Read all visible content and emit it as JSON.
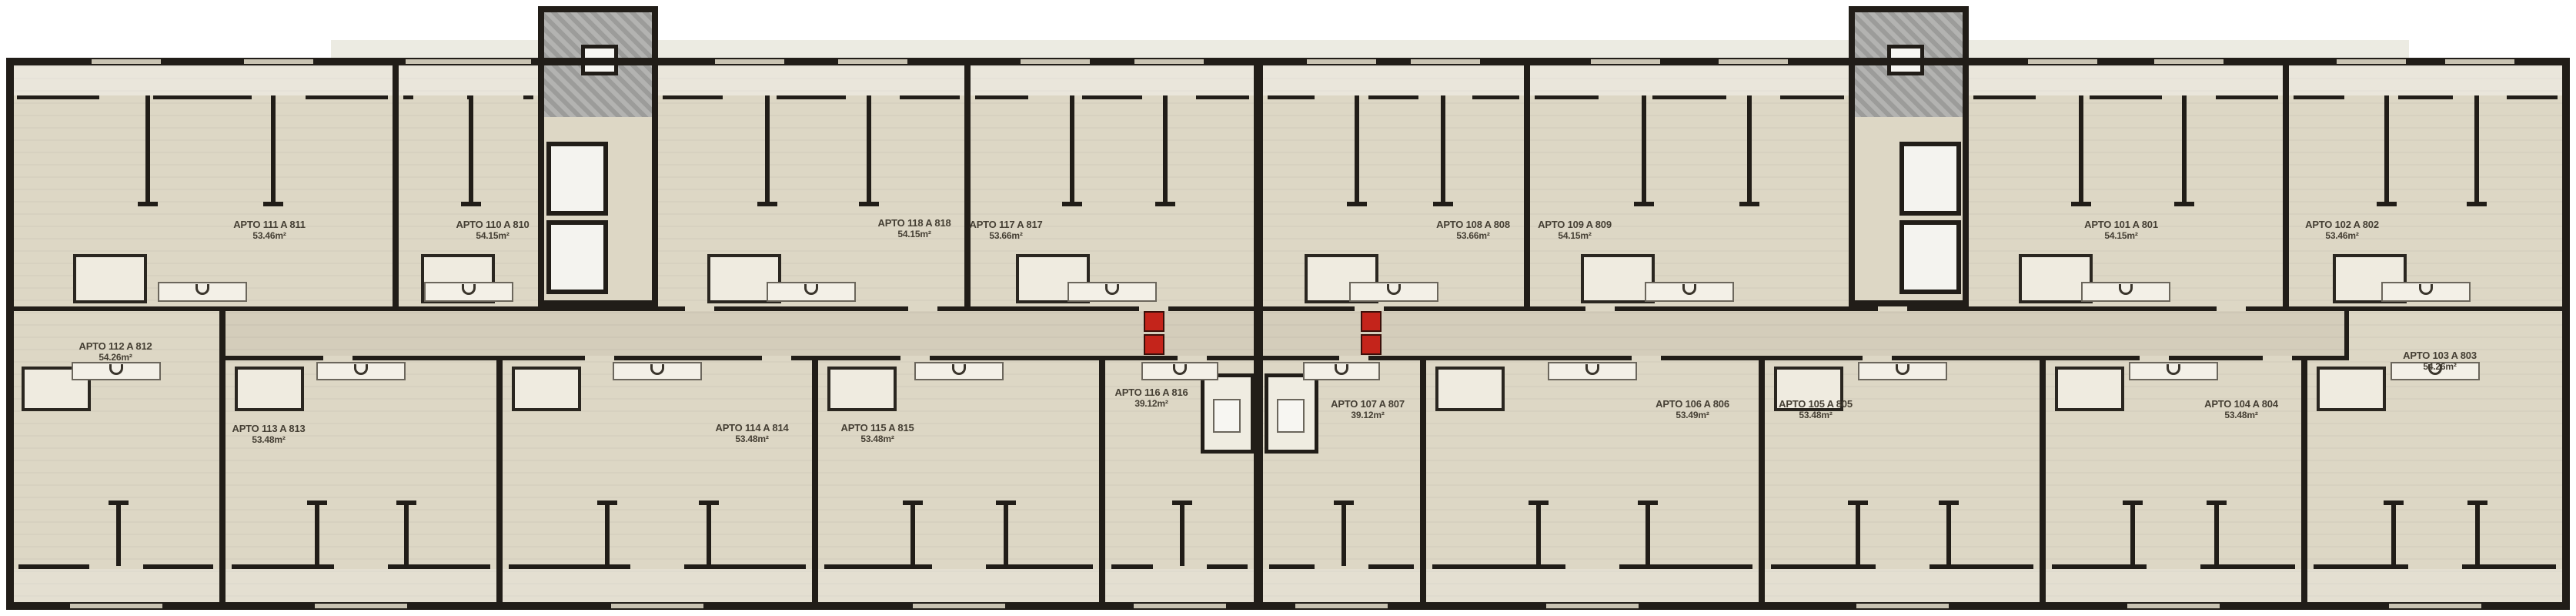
{
  "plan": {
    "apartments": [
      {
        "id": "111",
        "label": "APTO 111 A 811",
        "area": "53.46m²"
      },
      {
        "id": "110",
        "label": "APTO 110 A 810",
        "area": "54.15m²"
      },
      {
        "id": "118",
        "label": "APTO 118 A 818",
        "area": "54.15m²"
      },
      {
        "id": "117",
        "label": "APTO 117 A 817",
        "area": "53.66m²"
      },
      {
        "id": "108",
        "label": "APTO 108 A 808",
        "area": "53.66m²"
      },
      {
        "id": "109",
        "label": "APTO 109 A 809",
        "area": "54.15m²"
      },
      {
        "id": "101",
        "label": "APTO 101 A 801",
        "area": "54.15m²"
      },
      {
        "id": "102",
        "label": "APTO 102 A 802",
        "area": "53.46m²"
      },
      {
        "id": "112",
        "label": "APTO 112 A 812",
        "area": "54.26m²"
      },
      {
        "id": "113",
        "label": "APTO 113 A 813",
        "area": "53.48m²"
      },
      {
        "id": "114",
        "label": "APTO 114 A 814",
        "area": "53.48m²"
      },
      {
        "id": "115",
        "label": "APTO 115 A 815",
        "area": "53.48m²"
      },
      {
        "id": "116",
        "label": "APTO 116 A 816",
        "area": "39.12m²"
      },
      {
        "id": "107",
        "label": "APTO 107 A 807",
        "area": "39.12m²"
      },
      {
        "id": "106",
        "label": "APTO 106 A 806",
        "area": "53.49m²"
      },
      {
        "id": "105",
        "label": "APTO 105 A 805",
        "area": "53.48m²"
      },
      {
        "id": "104",
        "label": "APTO 104 A 804",
        "area": "53.48m²"
      },
      {
        "id": "103",
        "label": "APTO 103 A 803",
        "area": "54.26m²"
      }
    ],
    "colors": {
      "background": "#ffffff",
      "floor": "#ddd7c5",
      "wall": "#211d18",
      "core_gray": "#a9a9a7",
      "elevator_fill": "#f4f3ef",
      "fire_door_red": "#c4241b",
      "label_text": "#453f34"
    }
  }
}
